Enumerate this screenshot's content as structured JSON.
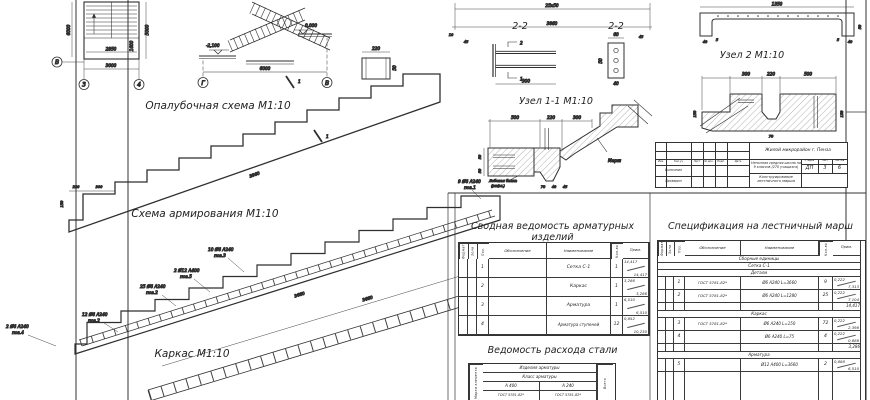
{
  "titles": {
    "formwork": "Опалубочная схема М1:10",
    "reinforcement": "Схема армирования М1:10",
    "frame": "Каркас М1:10",
    "sec22a": "2-2",
    "sec22b": "2-2",
    "node1": "Узел 1-1 М1:10",
    "node2": "Узел 2 М1:10",
    "summary": "Сводная ведомость арматурных изделий",
    "steel": "Ведомость расхода стали",
    "spec": "Спецификация на лестничный марш"
  },
  "plan": {
    "axis_v": "В",
    "axis_3": "3",
    "axis_4": "4",
    "w": "3000",
    "w_in": "2950",
    "h_l": "6000",
    "h_r": "5000",
    "v_in": "1600"
  },
  "elev": {
    "axis_g": "Г",
    "axis_v": "В",
    "w": "6000",
    "lvl0": "0,000",
    "lvl1": "-2,100"
  },
  "topdims": {
    "d1": "25х50",
    "d2": "3860",
    "d3": "45",
    "d4": "45",
    "d5": "10"
  },
  "beam": {
    "w": "1350",
    "a": "40",
    "b": "5",
    "c": "5",
    "d": "40",
    "h": "50"
  },
  "detail": {
    "w": "220",
    "h": "50"
  },
  "formwork": {
    "slope": "3960",
    "cut": "1",
    "d1": "220",
    "d2": "300",
    "d3": "150"
  },
  "reinf": {
    "slope": "3660",
    "a1": "9 Ø6 А240",
    "a1p": "поз.1",
    "a2": "10 Ø6 А240",
    "a2p": "поз.3",
    "a3": "2 Ø12 А400",
    "a3p": "поз.5",
    "a4": "25 Ø6 А240",
    "a4p": "поз.2",
    "a5": "12 Ø6 А240",
    "a5p": "поз.2",
    "a6": "2 Ø6 А240",
    "a6p": "поз.4"
  },
  "frame_dim": {
    "slope": "3660"
  },
  "s22a": {
    "dim": "300",
    "m1": "1",
    "m2": "2"
  },
  "s22b": {
    "top": "60",
    "left": "50",
    "bottom": "40"
  },
  "node1d": {
    "d1": "500",
    "d2": "220",
    "d3": "300",
    "v1": "50",
    "v2": "50",
    "b1": "70",
    "b2": "40",
    "b3": "45",
    "note1": "Лобовая балка",
    "note2": "(рифл.)",
    "flight": "Марш"
  },
  "node2d": {
    "d1": "300",
    "d2": "220",
    "d3": "500",
    "v1": "150",
    "v2": "150",
    "b1": "70"
  },
  "tb": {
    "project": "Жилой микрорайон г. Пенза",
    "object": "Неполная средняя школа на 9 классов (270 учащихся)",
    "doc": "Конструирование лестничного марша",
    "h_stage": "Стадия",
    "h_sheet": "Лист",
    "h_sheets": "Листов",
    "stage": "ДП",
    "sheet": "3",
    "sheets": "6",
    "c1": "Изм.",
    "c2": "Кол.уч",
    "c3": "Лист",
    "c4": "№ док.",
    "c5": "Подп.",
    "c6": "Дата",
    "r1": "Выполнил",
    "r2": "Проверил"
  },
  "cols": {
    "format": "Формат",
    "zone": "Зона",
    "pos": "Поз.",
    "desig": "Обозначение",
    "name": "Наименование",
    "qty": "Кол-во",
    "note": "Прим."
  },
  "summary_rows": [
    {
      "pos": "1",
      "desig": "",
      "name": "Сетка С-1",
      "qty": "1",
      "m1": "14,417",
      "m2": "14,417"
    },
    {
      "pos": "2",
      "desig": "",
      "name": "Каркас",
      "qty": "1",
      "m1": "3,286",
      "m2": "3,286"
    },
    {
      "pos": "3",
      "desig": "",
      "name": "Арматура",
      "qty": "1",
      "m1": "6,510",
      "m2": "6,510"
    },
    {
      "pos": "4",
      "desig": "",
      "name": "Арматура ступеней",
      "qty": "12",
      "m1": "0,852",
      "m2": "10,230"
    }
  ],
  "steel": {
    "element": "Марка элемента",
    "h1": "Изделия арматуры",
    "h2": "Класс арматуры",
    "c1": "А 400",
    "c2": "А 240",
    "g1": "ГОСТ 5781-82*",
    "g2": "ГОСТ 5781-82*",
    "total": "Всего"
  },
  "spec_secs": {
    "s1": "Сборные единицы",
    "s2": "Сетка С-1",
    "s3": "Детали",
    "s4": "Каркас",
    "s5": "Арматура"
  },
  "spec_rows": [
    {
      "pos": "1",
      "desig": "ГОСТ 5781-82*",
      "name": "Ø6 А240 L=3660",
      "qty": "9",
      "m1": "0,222",
      "m2": "7,313"
    },
    {
      "pos": "2",
      "desig": "ГОСТ 5781-82*",
      "name": "Ø6 А240 L=1280",
      "qty": "25",
      "m1": "0,222",
      "m2": "7,104"
    },
    {
      "pos": "3",
      "desig": "ГОСТ 5781-82*",
      "name": "Ø6 А240 L=150",
      "qty": "72",
      "m1": "0,222",
      "m2": "2,398"
    },
    {
      "pos": "4",
      "desig": "",
      "name": "Ø6 А240 L=75",
      "qty": "4",
      "m1": "0,222",
      "m2": "0,888"
    },
    {
      "pos": "5",
      "desig": "",
      "name": "Ø12 А400 L=3660",
      "qty": "2",
      "m1": "0,888",
      "m2": "6,510"
    }
  ],
  "spec_totals": {
    "t1": "14,417",
    "t2": "3,286"
  }
}
